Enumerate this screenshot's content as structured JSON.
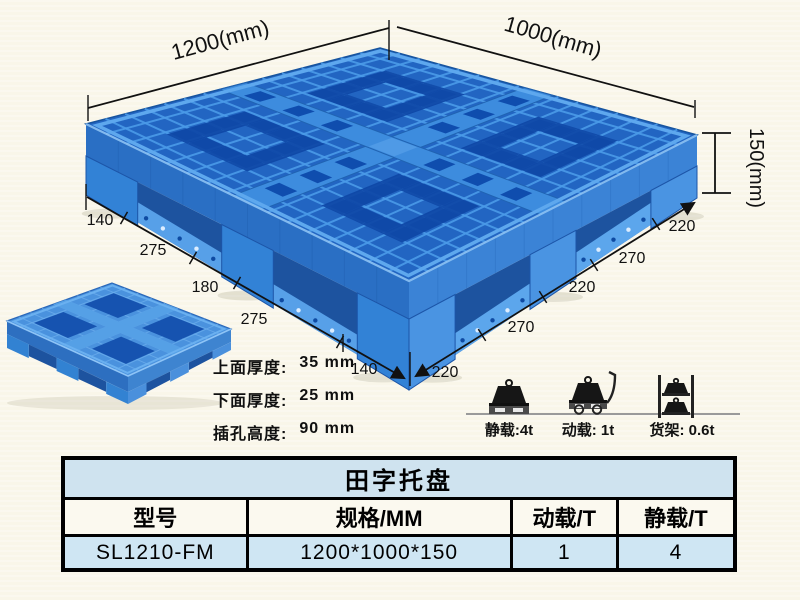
{
  "colors": {
    "background": "#f9f6e9",
    "pallet_blue": "#2265c2",
    "pallet_hole_blue": "#0e46a6",
    "table_title_bg": "#cfe3ef",
    "table_header_bg": "#fbf9ef",
    "table_data_bg": "#cfe6f3"
  },
  "annotations": {
    "length": "1200(mm)",
    "width": "1000(mm)",
    "height": "150(mm)",
    "bottom_left_segments": [
      "140",
      "275",
      "180",
      "275",
      "140"
    ],
    "bottom_right_segments": [
      "220",
      "270",
      "220",
      "270",
      "220"
    ]
  },
  "notes": [
    {
      "label": "上面厚度:",
      "value": "35 mm"
    },
    {
      "label": "下面厚度:",
      "value": "25 mm"
    },
    {
      "label": "插孔高度:",
      "value": "90 mm"
    }
  ],
  "load_ratings": [
    {
      "icon": "static-load-icon",
      "label": "静载:4t"
    },
    {
      "icon": "dynamic-load-icon",
      "label": "动载: 1t"
    },
    {
      "icon": "rack-load-icon",
      "label": "货架: 0.6t"
    }
  ],
  "table": {
    "title": "田字托盘",
    "headers": [
      "型号",
      "规格/MM",
      "动载/T",
      "静载/T"
    ],
    "rows": [
      [
        "SL1210-FM",
        "1200*1000*150",
        "1",
        "4"
      ]
    ]
  }
}
